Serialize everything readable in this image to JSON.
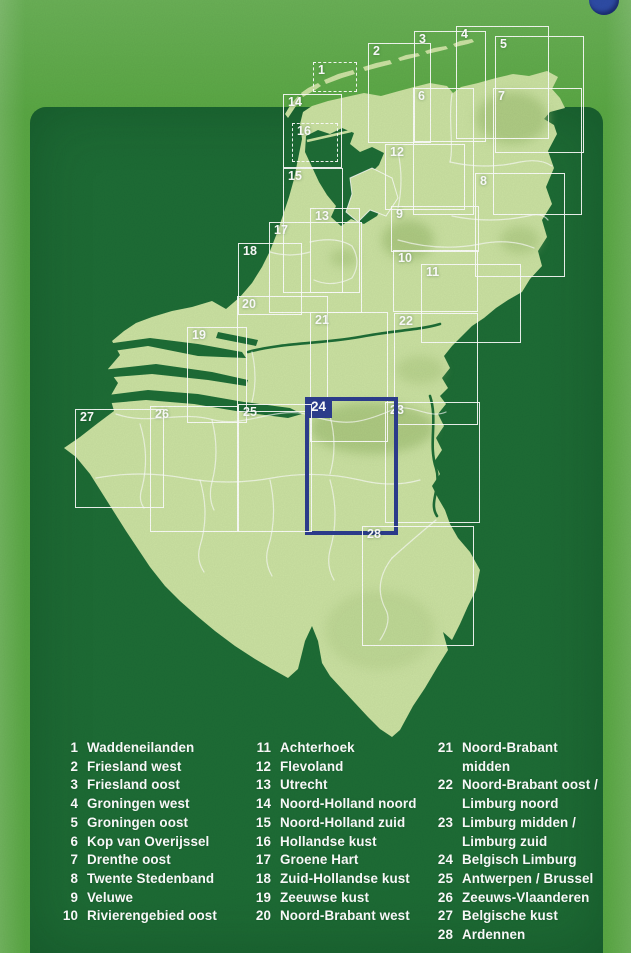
{
  "colors": {
    "outer_green": "#5aa844",
    "panel_green": "#1e6d36",
    "land_green": "#cbe2a2",
    "land_shade_olive": "#a6c47a",
    "border_white": "#ffffff",
    "accent_blue": "#2c3d8e",
    "badge_blue": "#2e4ca6",
    "legend_text": "#ffffff"
  },
  "index_map": {
    "highlighted_sheet": "24",
    "sheets": [
      {
        "num": "1",
        "x": 313,
        "y": 62,
        "w": 44,
        "h": 30,
        "style": "dashed"
      },
      {
        "num": "2",
        "x": 368,
        "y": 43,
        "w": 63,
        "h": 100,
        "style": "solid"
      },
      {
        "num": "3",
        "x": 414,
        "y": 31,
        "w": 72,
        "h": 111,
        "style": "solid"
      },
      {
        "num": "4",
        "x": 456,
        "y": 26,
        "w": 93,
        "h": 113,
        "style": "solid"
      },
      {
        "num": "5",
        "x": 495,
        "y": 36,
        "w": 89,
        "h": 117,
        "style": "solid"
      },
      {
        "num": "6",
        "x": 413,
        "y": 88,
        "w": 61,
        "h": 127,
        "style": "solid"
      },
      {
        "num": "7",
        "x": 493,
        "y": 88,
        "w": 89,
        "h": 127,
        "style": "solid"
      },
      {
        "num": "8",
        "x": 475,
        "y": 173,
        "w": 90,
        "h": 104,
        "style": "solid"
      },
      {
        "num": "9",
        "x": 391,
        "y": 206,
        "w": 88,
        "h": 46,
        "style": "solid"
      },
      {
        "num": "10",
        "x": 393,
        "y": 250,
        "w": 85,
        "h": 62,
        "style": "solid"
      },
      {
        "num": "11",
        "x": 421,
        "y": 264,
        "w": 100,
        "h": 79,
        "style": "solid"
      },
      {
        "num": "12",
        "x": 385,
        "y": 144,
        "w": 80,
        "h": 66,
        "style": "solid"
      },
      {
        "num": "13",
        "x": 310,
        "y": 208,
        "w": 50,
        "h": 85,
        "style": "solid"
      },
      {
        "num": "14",
        "x": 283,
        "y": 94,
        "w": 59,
        "h": 74,
        "style": "solid"
      },
      {
        "num": "15",
        "x": 283,
        "y": 168,
        "w": 60,
        "h": 125,
        "style": "solid"
      },
      {
        "num": "16",
        "x": 292,
        "y": 123,
        "w": 46,
        "h": 39,
        "style": "dashed"
      },
      {
        "num": "17",
        "x": 269,
        "y": 222,
        "w": 93,
        "h": 91,
        "style": "solid"
      },
      {
        "num": "18",
        "x": 238,
        "y": 243,
        "w": 64,
        "h": 72,
        "style": "solid"
      },
      {
        "num": "19",
        "x": 187,
        "y": 327,
        "w": 60,
        "h": 96,
        "style": "solid"
      },
      {
        "num": "20",
        "x": 237,
        "y": 296,
        "w": 91,
        "h": 116,
        "style": "solid"
      },
      {
        "num": "21",
        "x": 310,
        "y": 312,
        "w": 78,
        "h": 130,
        "style": "solid"
      },
      {
        "num": "22",
        "x": 394,
        "y": 313,
        "w": 84,
        "h": 112,
        "style": "solid"
      },
      {
        "num": "23",
        "x": 385,
        "y": 402,
        "w": 95,
        "h": 121,
        "style": "solid"
      },
      {
        "num": "24",
        "x": 305,
        "y": 397,
        "w": 93,
        "h": 138,
        "style": "highlight"
      },
      {
        "num": "25",
        "x": 238,
        "y": 404,
        "w": 74,
        "h": 128,
        "style": "solid"
      },
      {
        "num": "26",
        "x": 150,
        "y": 406,
        "w": 88,
        "h": 126,
        "style": "solid"
      },
      {
        "num": "27",
        "x": 75,
        "y": 409,
        "w": 89,
        "h": 99,
        "style": "solid"
      },
      {
        "num": "28",
        "x": 362,
        "y": 526,
        "w": 112,
        "h": 120,
        "style": "solid"
      }
    ]
  },
  "legend": {
    "columns": [
      {
        "items": [
          {
            "num": "1",
            "label": "Waddeneilanden"
          },
          {
            "num": "2",
            "label": "Friesland west"
          },
          {
            "num": "3",
            "label": "Friesland oost"
          },
          {
            "num": "4",
            "label": "Groningen west"
          },
          {
            "num": "5",
            "label": "Groningen oost"
          },
          {
            "num": "6",
            "label": "Kop van Overijssel"
          },
          {
            "num": "7",
            "label": "Drenthe oost"
          },
          {
            "num": "8",
            "label": "Twente Stedenband"
          },
          {
            "num": "9",
            "label": "Veluwe"
          },
          {
            "num": "10",
            "label": "Rivierengebied oost"
          }
        ]
      },
      {
        "items": [
          {
            "num": "11",
            "label": "Achterhoek"
          },
          {
            "num": "12",
            "label": "Flevoland"
          },
          {
            "num": "13",
            "label": "Utrecht"
          },
          {
            "num": "14",
            "label": "Noord-Holland noord"
          },
          {
            "num": "15",
            "label": "Noord-Holland zuid"
          },
          {
            "num": "16",
            "label": "Hollandse kust"
          },
          {
            "num": "17",
            "label": "Groene Hart"
          },
          {
            "num": "18",
            "label": "Zuid-Hollandse kust"
          },
          {
            "num": "19",
            "label": "Zeeuwse kust"
          },
          {
            "num": "20",
            "label": "Noord-Brabant west"
          }
        ]
      },
      {
        "items": [
          {
            "num": "21",
            "label": "Noord-Brabant midden"
          },
          {
            "num": "22",
            "label": "Noord-Brabant oost /\nLimburg noord"
          },
          {
            "num": "23",
            "label": "Limburg midden /\nLimburg zuid"
          },
          {
            "num": "24",
            "label": "Belgisch Limburg"
          },
          {
            "num": "25",
            "label": "Antwerpen / Brussel"
          },
          {
            "num": "26",
            "label": "Zeeuws-Vlaanderen"
          },
          {
            "num": "27",
            "label": "Belgische kust"
          },
          {
            "num": "28",
            "label": "Ardennen"
          }
        ]
      }
    ]
  }
}
